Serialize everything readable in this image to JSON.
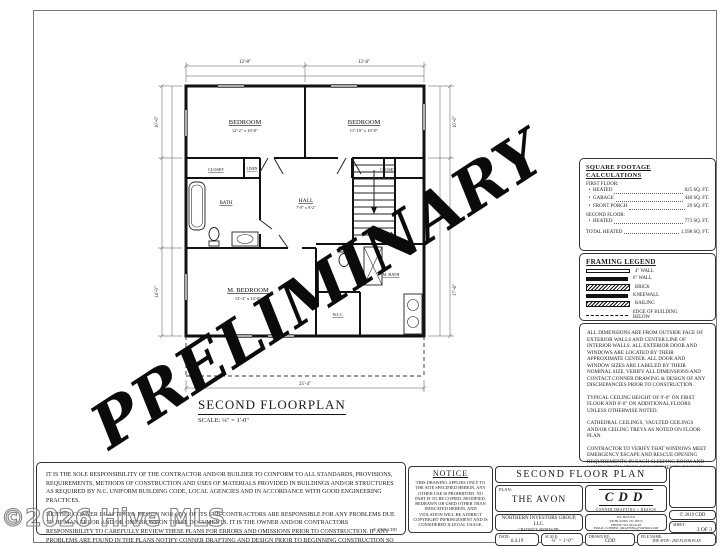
{
  "watermarks": {
    "preliminary": "PRELIMINARY",
    "hive": "©2026 Hive MLS"
  },
  "plan": {
    "title": "SECOND FLOORPLAN",
    "scale": "SCALE: ¼\" = 1'-0\"",
    "rooms": {
      "bedroom_left": {
        "name": "BEDROOM",
        "dims": "12'-2\" x 10'-0\""
      },
      "bedroom_right": {
        "name": "BEDROOM",
        "dims": "11'-10\" x 10'-0\""
      },
      "m_bedroom": {
        "name": "M. BEDROOM",
        "dims": "13'-4\" x 14'-0\""
      },
      "hall": {
        "name": "HALL",
        "dims": "7'-8\" x 9'-2\""
      },
      "bath": {
        "name": "BATH"
      },
      "linen": {
        "name": "LINEN"
      },
      "closet_left": {
        "name": "CLOSET"
      },
      "closet_right": {
        "name": "CLOSET"
      },
      "m_bath": {
        "name": "M. BATH"
      },
      "wic": {
        "name": "W.I.C."
      }
    },
    "dim_labels": {
      "top_left": "12'-8\"",
      "top_right": "12'-8\"",
      "left_upper": "10'-0\"",
      "left_lower": "14'-0\"",
      "right_upper": "10'-0\"",
      "right_lower": "17'-6\"",
      "bottom_overall": "25'-4\""
    }
  },
  "right_panel": {
    "sqft": {
      "title": "SQUARE FOOTAGE CALCULATIONS",
      "rows": [
        {
          "bullet": "",
          "label": "FIRST FLOOR:",
          "value": ""
        },
        {
          "bullet": "•",
          "label": "HEATED",
          "value": "825 SQ. FT."
        },
        {
          "bullet": "•",
          "label": "GARAGE",
          "value": "440 SQ. FT."
        },
        {
          "bullet": "•",
          "label": "FRONT PORCH",
          "value": "29 SQ. FT."
        },
        {
          "bullet": "",
          "label": "SECOND FLOOR:",
          "value": ""
        },
        {
          "bullet": "•",
          "label": "HEATED",
          "value": "773 SQ. FT."
        }
      ],
      "total_label": "TOTAL HEATED",
      "total_value": "1,598 SQ. FT."
    },
    "legend": {
      "title": "FRAMING LEGEND",
      "items": [
        {
          "label": "4\" WALL"
        },
        {
          "label": "6\" WALL"
        },
        {
          "label": "BRICK"
        },
        {
          "label": "KNEEWALL"
        },
        {
          "label": "RAILING"
        },
        {
          "label": "EDGE OF BUILDING BELOW"
        }
      ]
    },
    "notes": [
      "ALL DIMENSIONS ARE FROM OUTSIDE FACE OF EXTERIOR WALLS AND CENTER LINE OF INTERIOR WALLS. ALL EXTERIOR DOOR AND WINDOWS ARE LOCATED BY THEIR APPROXIMATE CENTER. ALL DOOR AND WINDOW SIZES ARE LABELED BY THEIR NOMINAL SIZE. VERIFY ALL DIMENSIONS AND CONTACT CONNER DRAWING & DESIGN OF ANY DISCREPANCIES PRIOR TO CONSTRUCTION.",
      "TYPICAL CEILING HEIGHT OF 9'-0\" ON FIRST FLOOR AND 8'-0\" ON ADDITIONAL FLOORS UNLESS OTHERWISE NOTED.",
      "CATHEDRAL CEILINGS, VAULTED CEILINGS AND/OR CEILING TREYS AS NOTED ON FLOOR PLAN.",
      "CONTRACTOR TO VERIFY THAT WINDOWS MEET EMERGENCY ESCAPE AND RESCUE OPENING REQUIREMENTS IN EACH SLEEPING ROOM AND LIGHT/VENTILATION REQUIREMENTS (R303) IN EACH HABITABLE ROOM."
    ]
  },
  "disclaimer": {
    "p1": "IT IS THE SOLE RESPONSIBILITY OF THE CONTRACTOR AND/OR BUILDER TO CONFORM TO ALL STANDARDS, PROVISIONS, REQUIREMENTS, METHODS OF CONSTRUCTION AND USES OF MATERIALS PROVIDED IN BUILDINGS AND/OR STRUCTURES AS REQUIRED BY N.C. UNIFORM BUILDING CODE, LOCAL AGENCIES AND IN ACCORDANCE WITH GOOD ENGINEERING PRACTICES.",
    "p2": "NEITHER CONNER DRAFTING & DESIGN NOR ANY OF ITS SUB-CONTRACTORS ARE RESPONSIBLE FOR ANY PROBLEMS DUE TO HUMAN ERROR AND/OR OMISSIONS ON THESE DOCUMENTS. IT IS THE OWNER AND/OR CONTRACTORS RESPONSIBILITY TO CAREFULLY REVIEW THESE PLANS FOR ERRORS AND OMISSIONS PRIOR TO CONSTRUCTION. IF ANY PROBLEMS ARE FOUND IN THE PLANS NOTIFY CONNER DRAFTING AND DESIGN PRIOR TO BEGINNING CONSTRUCTION SO ANY REVISIONS CAN BE MADE.",
    "copyright": "© 2019 CDD"
  },
  "titleblock": {
    "notice_title": "NOTICE",
    "notice_body": "THIS DRAWING APPLIES ONLY TO THE SITE SPECIFIED HEREIN, ANY OTHER USE IS PROHIBITED. NO PART IS TO BE COPIED, MODIFIED, REDRAWN OR USED OTHER THAN INDICATED HEREIN, AND VIOLATION WILL BE A DIRECT COPYRIGHT INFRINGEMENT AND IS CONSIDERED ILLEGAL USAGE.",
    "header": "SECOND FLOOR PLAN",
    "plan_label": "PLAN:",
    "plan_name": "THE AVON",
    "logo_text": "CDD",
    "logo_sub": "CONNER DRAFTING + DESIGN",
    "client_name": "NORTHERN INVESTORS GROUP, LLC.",
    "client_addr1": "CHADWICK SHORES DR.",
    "client_addr2": "SNEADS FERRY, NC 28460",
    "contact_lines": [
      "P.O. BOX 841",
      "RICHLANDS, NC 28574",
      "PHONE: 910.324.4148",
      "EMAIL: CONNER_DRAFTING@YAHOO.COM"
    ],
    "copyright": "© 2019 CDD",
    "sheet_label": "SHEET:",
    "sheet_value": "3 OF 3",
    "date_label": "DATE:",
    "date_value": "6.4.19",
    "scale_label": "SCALE:",
    "scale_value": "¼\" = 1'-0\"",
    "drawn_label": "DRAWN BY:",
    "drawn_value": "CDD",
    "file_label": "FILE NAME:",
    "file_value": "THE AVON - 2ND FLOOR PLAN"
  }
}
